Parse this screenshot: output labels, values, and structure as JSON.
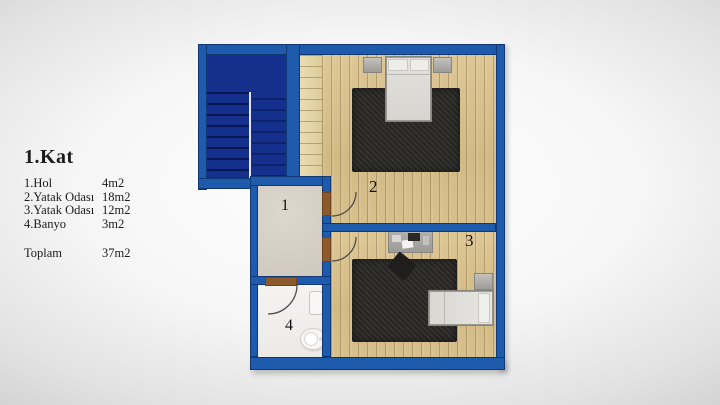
{
  "legend": {
    "title": "1.Kat",
    "rows": [
      {
        "label": "1.Hol",
        "area": "4m2"
      },
      {
        "label": "2.Yatak Odası",
        "area": "18m2"
      },
      {
        "label": "3.Yatak Odası",
        "area": "12m2"
      },
      {
        "label": "4.Banyo",
        "area": "3m2"
      }
    ],
    "total": {
      "label": "Toplam",
      "area": "37m2"
    }
  },
  "plan": {
    "rooms": [
      {
        "number": "1",
        "name": "hol"
      },
      {
        "number": "2",
        "name": "yatak odası"
      },
      {
        "number": "3",
        "name": "yatak odası"
      },
      {
        "number": "4",
        "name": "banyo"
      }
    ],
    "colors": {
      "wall_blue": "#1e5bac",
      "stairwell_navy": "#14308c",
      "wood_floor": "#d6be8a",
      "rug_dark": "#2b2a27",
      "hall_floor": "#d6cfc6",
      "bath_floor": "#f2f1ee",
      "door_brown": "#8d5a2b"
    }
  }
}
